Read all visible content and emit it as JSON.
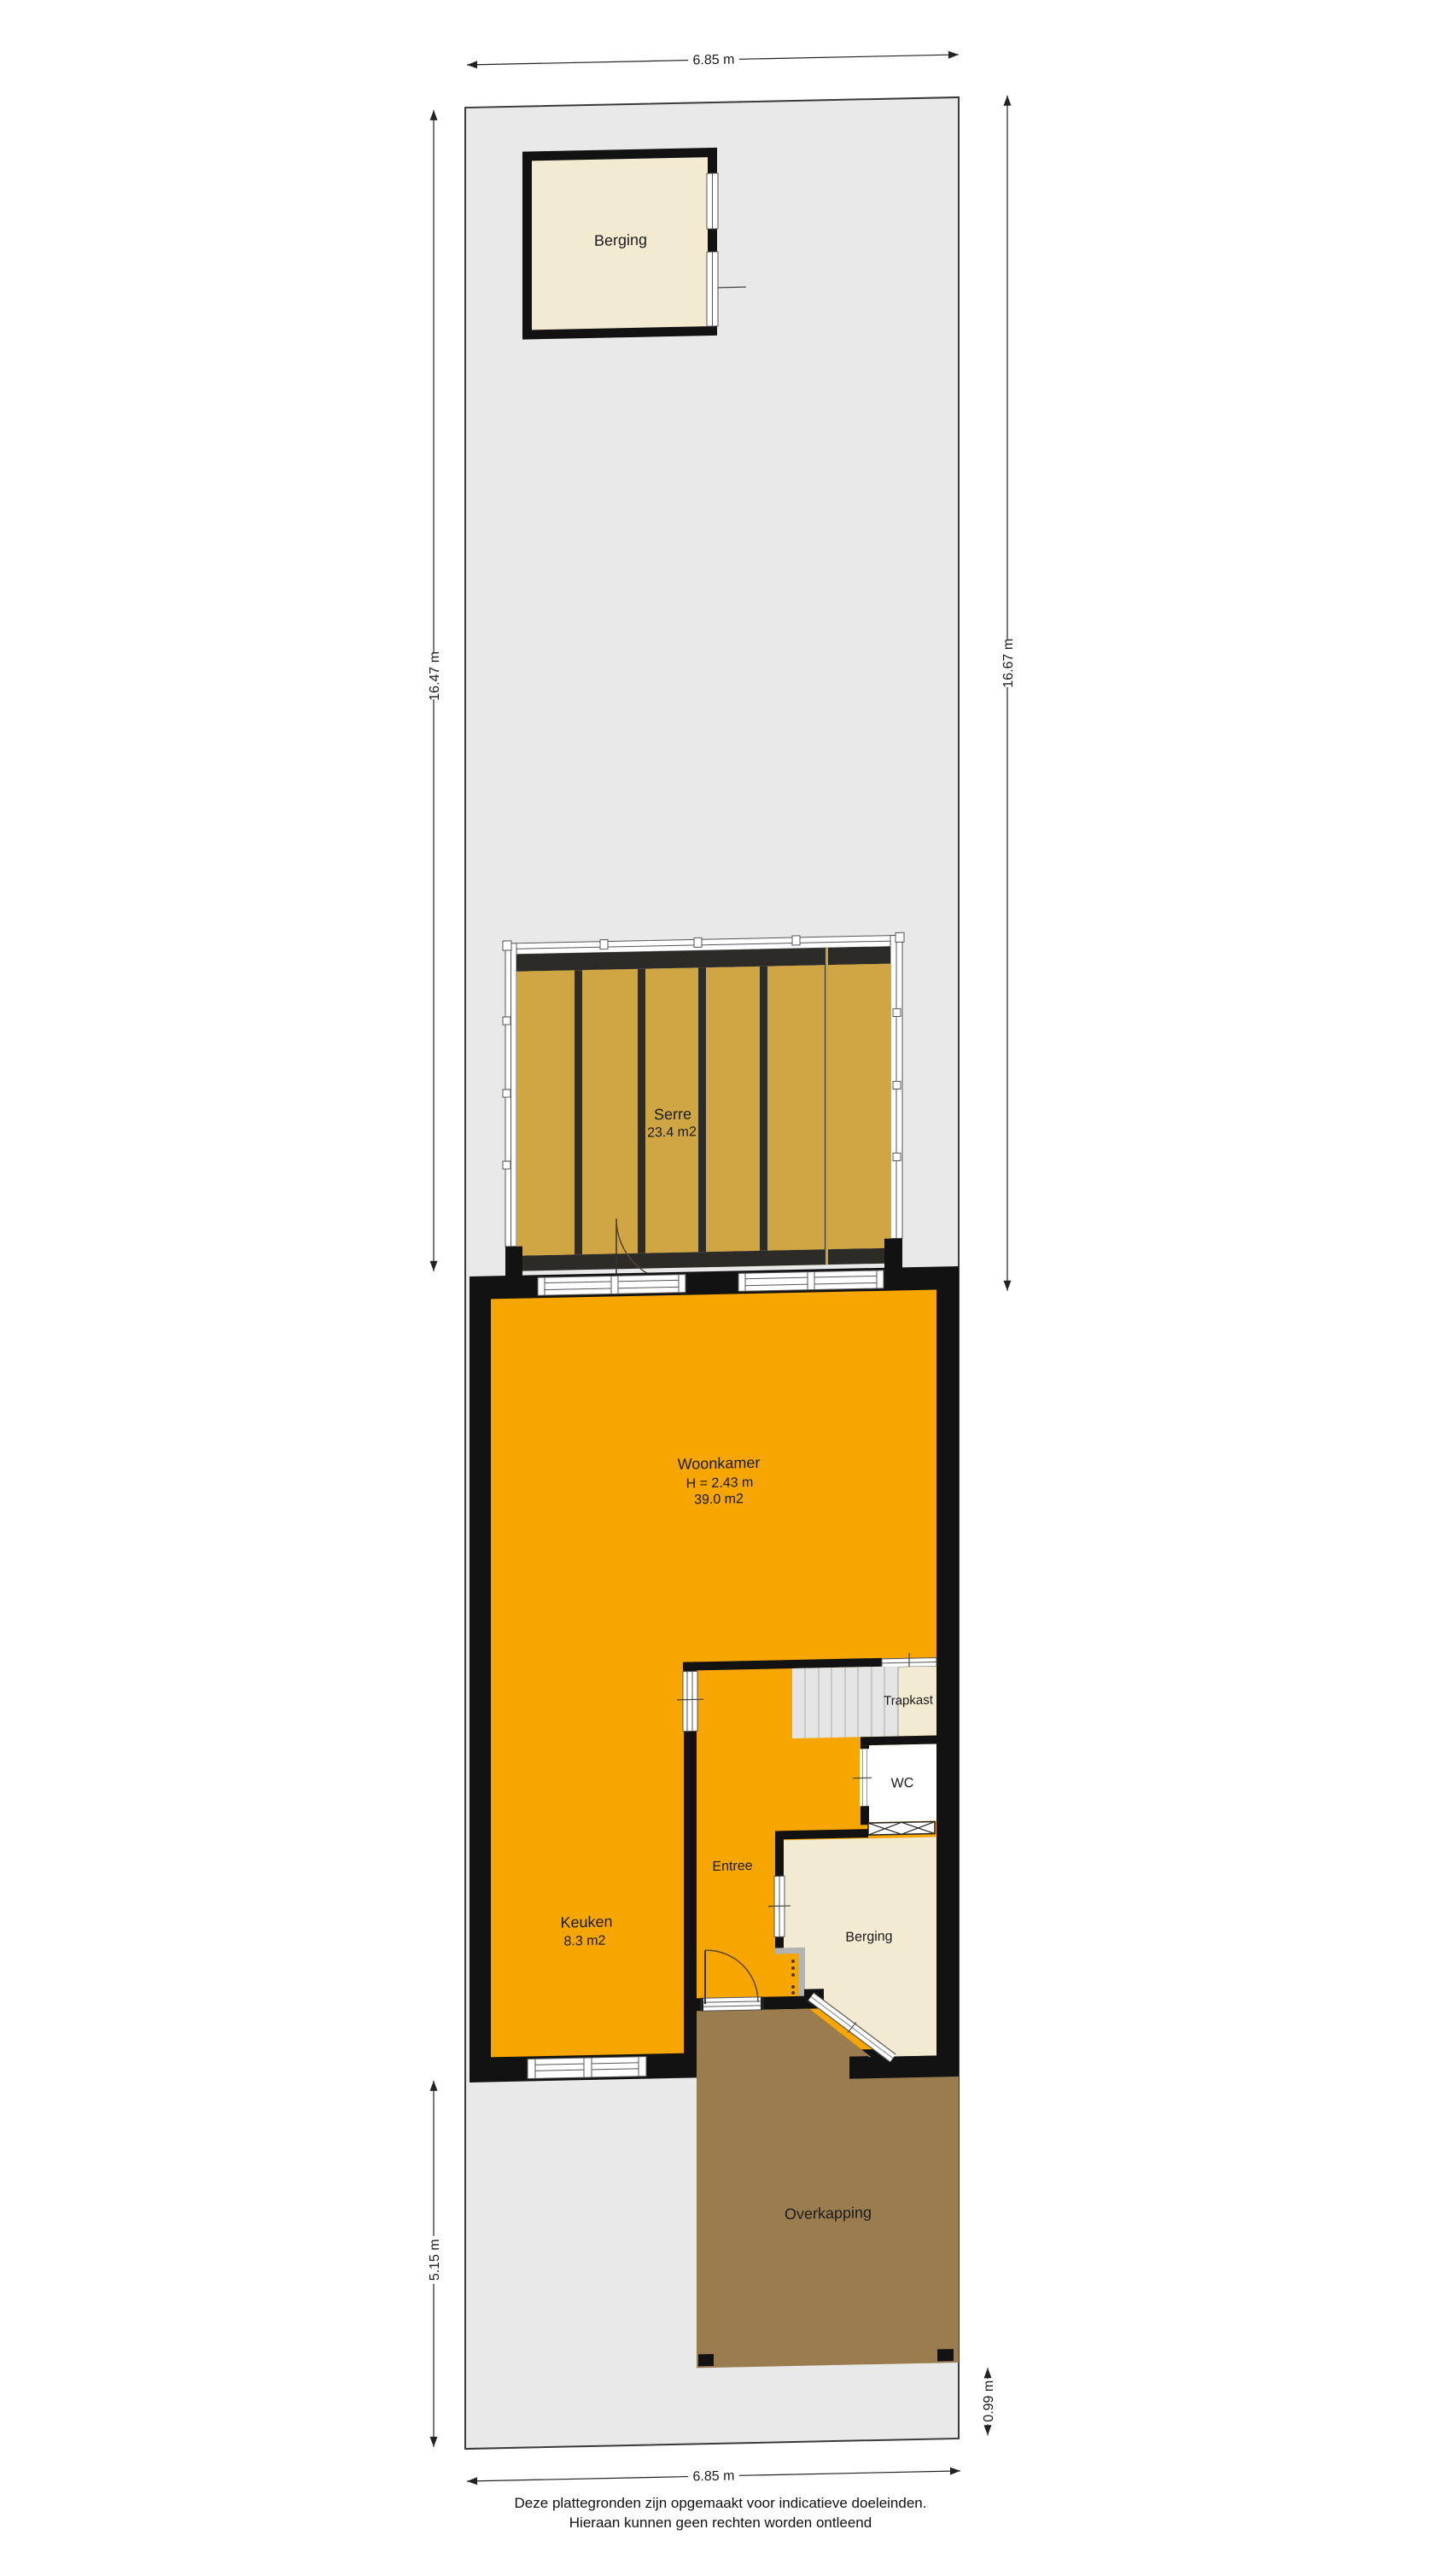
{
  "dimensions": {
    "top_width": "6.85 m",
    "left_height": "16.47 m",
    "right_height": "16.67 m",
    "garden_depth": "5.15 m",
    "path_depth": "0.99 m",
    "bottom_width": "6.85 m"
  },
  "rooms": {
    "berging_tuin": {
      "name": "Berging"
    },
    "serre": {
      "name": "Serre",
      "area": "23.4 m2"
    },
    "woonkamer": {
      "name": "Woonkamer",
      "ceiling": "H = 2.43 m",
      "area": "39.0 m2"
    },
    "trapkast": {
      "name": "Trapkast"
    },
    "wc": {
      "name": "WC"
    },
    "entree": {
      "name": "Entree"
    },
    "keuken": {
      "name": "Keuken",
      "area": "8.3 m2"
    },
    "berging": {
      "name": "Berging"
    },
    "overkapping": {
      "name": "Overkapping"
    }
  },
  "footer": {
    "line1": "Deze plattegronden zijn opgemaakt voor indicatieve doeleinden.",
    "line2": "Hieraan kunnen geen rechten worden ontleend"
  },
  "colors": {
    "floor_orange": "#f7a600",
    "serre_gold": "#cfa643",
    "serre_frame_dark": "#2c2b28",
    "wall_black": "#121212",
    "room_cream": "#f2ebd2",
    "terrace_brown": "#9a7c4f",
    "lot_gray": "#e9e9e9",
    "stairs_gray": "#e5e5e5",
    "cabinet_gray": "#b3b3b3"
  }
}
